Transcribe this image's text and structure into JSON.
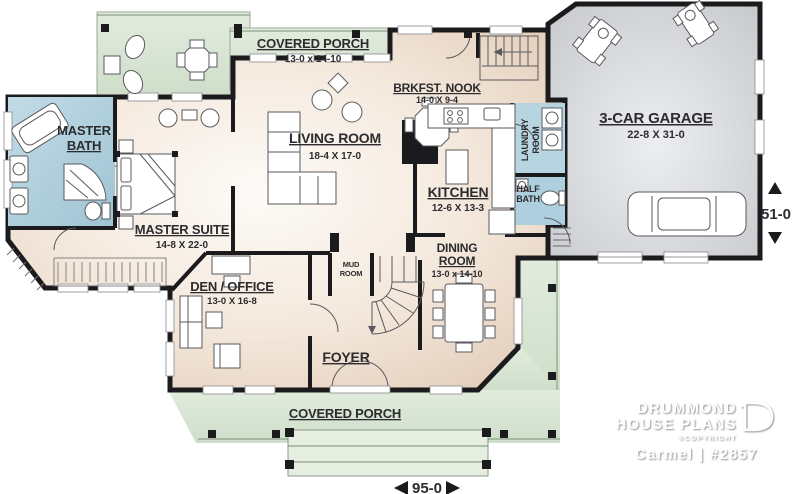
{
  "branding": {
    "logo_line1": "DRUMMOND",
    "logo_line2": "HOUSE PLANS",
    "copyright": "©COPYRIGHT",
    "plan_label": "Carmel | #2857"
  },
  "dimensions": {
    "width_label": "95-0",
    "depth_label": "51-0"
  },
  "rooms": {
    "covered_porch_top": {
      "name": "COVERED PORCH",
      "size": "13-0 x 14-10"
    },
    "covered_porch_bottom": {
      "name": "COVERED PORCH"
    },
    "master_bath": {
      "line1": "MASTER",
      "line2": "BATH"
    },
    "master_suite": {
      "name": "MASTER SUITE",
      "size": "14-8 X 22-0"
    },
    "living_room": {
      "name": "LIVING ROOM",
      "size": "18-4 X 17-0"
    },
    "brkfst_nook": {
      "name": "BRKFST. NOOK",
      "size": "14-0 X 9-4"
    },
    "kitchen": {
      "name": "KITCHEN",
      "size": "12-6 X 13-3"
    },
    "laundry_room": {
      "line1": "LAUNDRY",
      "line2": "ROOM"
    },
    "half_bath": {
      "line1": "HALF",
      "line2": "BATH"
    },
    "garage": {
      "name": "3-CAR GARAGE",
      "size": "22-8 X 31-0"
    },
    "dining_room": {
      "line1": "DINING",
      "line2": "ROOM",
      "size": "13-0 x 14-10"
    },
    "den_office": {
      "name": "DEN / OFFICE",
      "size": "13-0 X 16-8"
    },
    "mud_room": {
      "line1": "MUD",
      "line2": "ROOM"
    },
    "foyer": {
      "name": "FOYER"
    }
  },
  "colors": {
    "porch_green": "#d9e6d5",
    "bath_blue": "#a9cbd9",
    "laundry_blue": "#b7d5e1",
    "interior_beige": "#eddcce",
    "garage_gray": "#d3d5d8",
    "wall_black": "#1b1b1d"
  }
}
